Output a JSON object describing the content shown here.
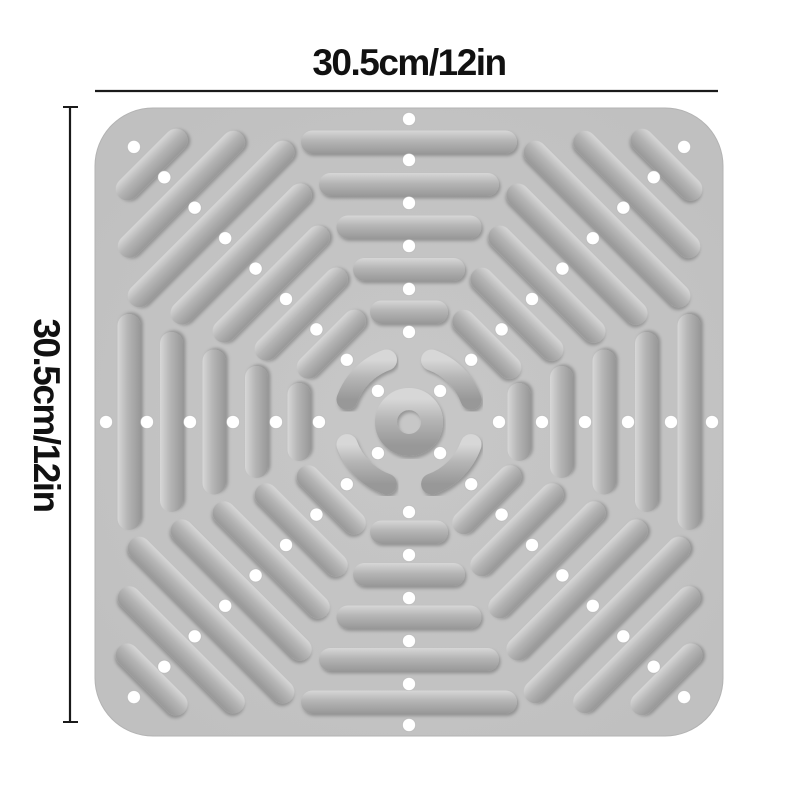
{
  "illustration": {
    "type": "product-dimension-illustration",
    "subject": "square anti-slip shower mat with raised massage bars, concentric ring texture and drain holes"
  },
  "dimension_labels": {
    "top": "30.5cm/12in",
    "left": "30.5cm/12in"
  },
  "colors": {
    "background": "#ffffff",
    "mat_base": "#c7c7c7",
    "mat_base_edge": "#bfbfbf",
    "mat_outline": "#b3b3b3",
    "bar_light": "#d7d7d7",
    "bar_mid": "#b5b5b5",
    "bar_dark": "#989898",
    "drain_hole": "#ffffff",
    "hole_rim": "#a8a8a8",
    "dimension_line": "#1a1a1a",
    "label_text": "#111111"
  },
  "counts": {
    "texture_rings": 5,
    "corner_bar_rows_per_corner": 2,
    "drain_holes": 60
  }
}
